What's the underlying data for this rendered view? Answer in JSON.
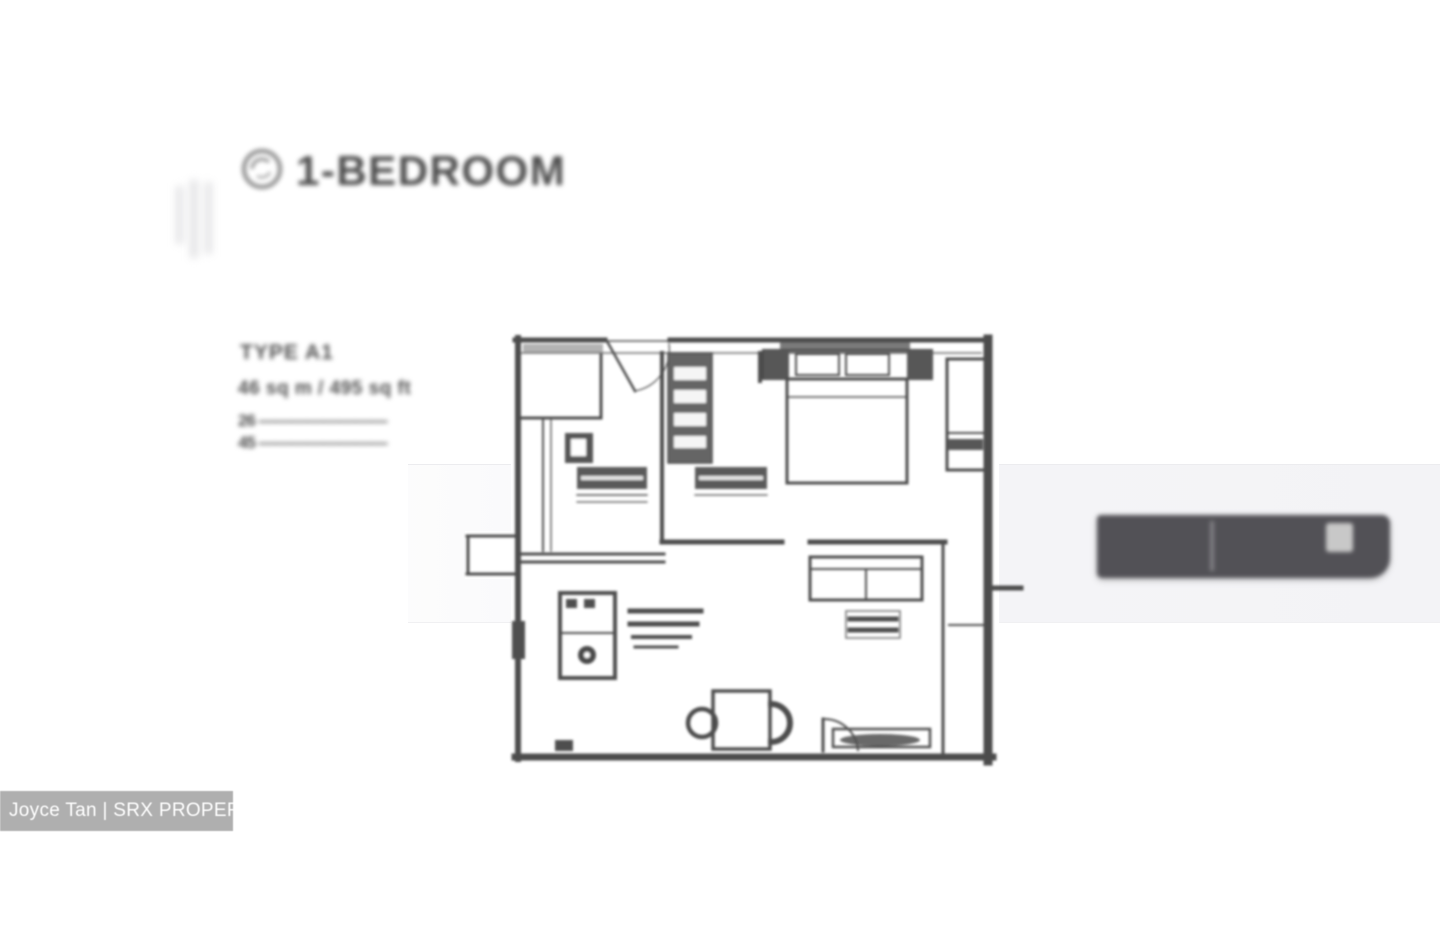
{
  "header": {
    "title": "1-BEDROOM",
    "icon": "circular-logo"
  },
  "unit_info": {
    "lines": [
      "TYPE A1",
      "46 sq m / 495 sq ft",
      "26 ————————",
      "45 ————————"
    ]
  },
  "floor_plan": {
    "elements": [
      "entry-door",
      "entry-closet",
      "wardrobe",
      "bathroom-sink",
      "kitchen-counters",
      "washer-dryer",
      "stove",
      "dining-table",
      "dining-chairs",
      "sofa",
      "coffee-table",
      "bed",
      "nightstands",
      "pillows",
      "tv-console",
      "balcony-door",
      "ac-ledge"
    ]
  },
  "banner": {
    "background": "#525156",
    "highlight_color": "#c8c8c8"
  },
  "watermark": {
    "text": "Joyce Tan | SRX PROPERTY",
    "background": "#a9a9a9",
    "text_color": "#ffffff"
  },
  "colors": {
    "band": "#f3f3f6",
    "plan_ink": "#3d3d3d",
    "title_ink": "#4d4d4d"
  }
}
